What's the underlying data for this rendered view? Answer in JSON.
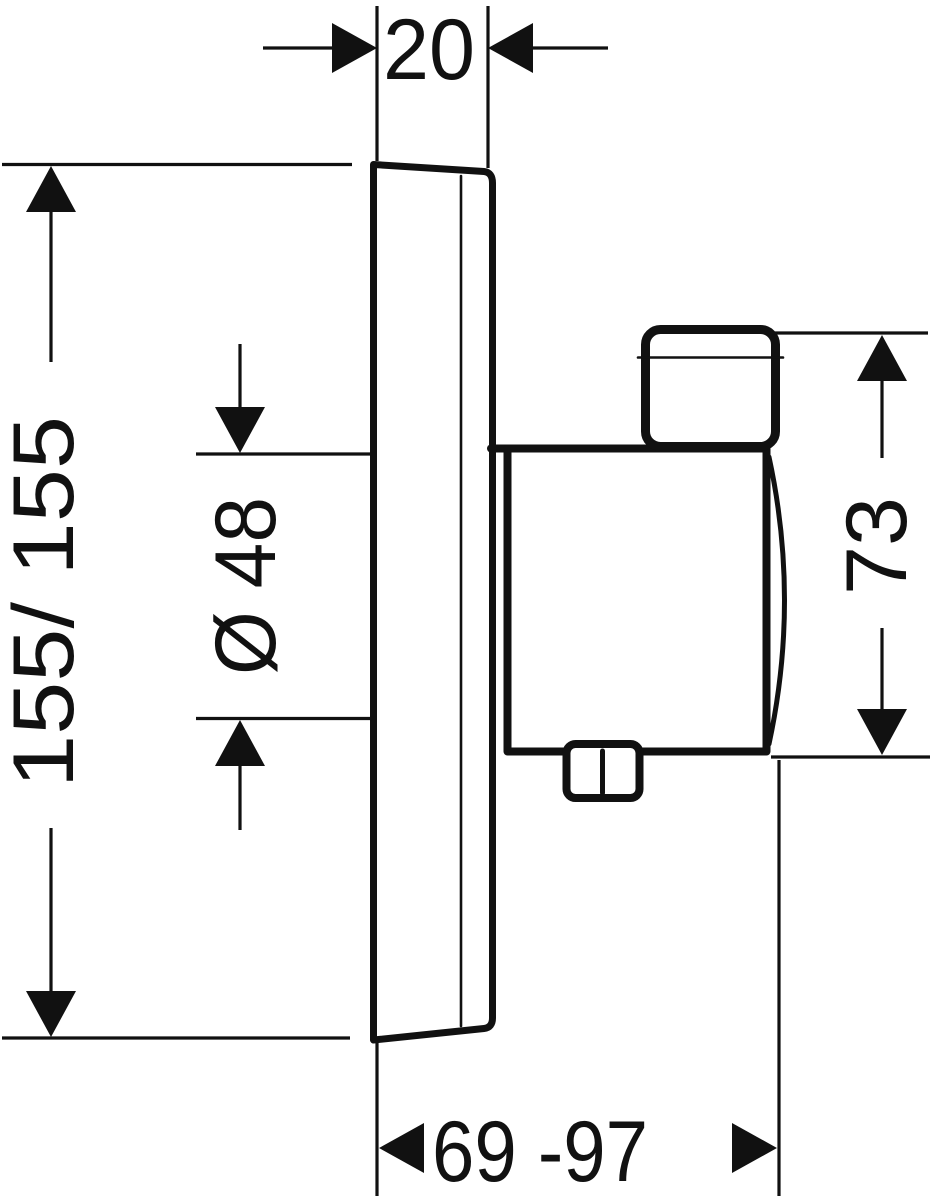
{
  "drawing": {
    "background_color": "#ffffff",
    "line_color": "#111111",
    "view": "side-elevation",
    "dimensions": {
      "plate_thickness": {
        "label": "20",
        "orientation": "horizontal"
      },
      "plate_size": {
        "label": "155/ 155",
        "orientation": "vertical"
      },
      "cutout_diameter": {
        "label": "Ø 48",
        "orientation": "vertical"
      },
      "body_height": {
        "label": "73",
        "orientation": "vertical"
      },
      "installation_depth": {
        "label": "69 -97",
        "orientation": "horizontal"
      }
    }
  }
}
